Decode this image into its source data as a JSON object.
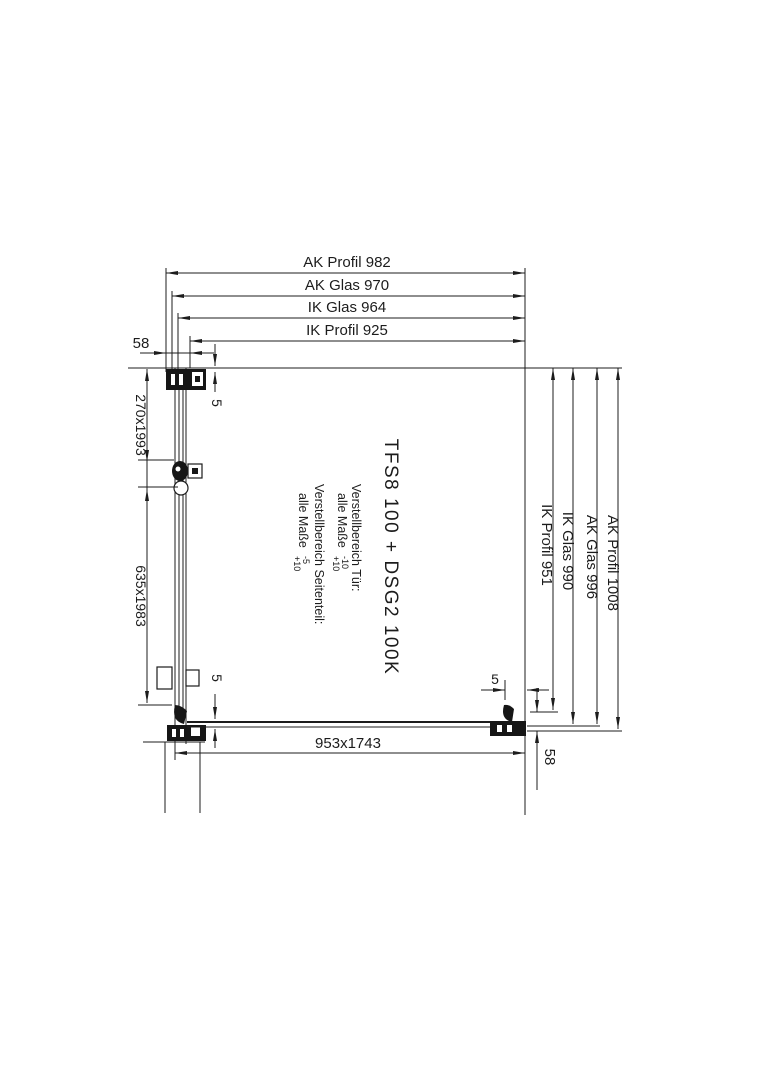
{
  "drawing": {
    "colors": {
      "line": "#1c1c1c",
      "background": "#ffffff"
    },
    "top_dims": [
      {
        "label": "AK Profil 982"
      },
      {
        "label": "AK Glas 970"
      },
      {
        "label": "IK Glas 964"
      },
      {
        "label": "IK Profil 925"
      }
    ],
    "right_dims": [
      {
        "label": "IK Profil 951"
      },
      {
        "label": "IK Glas 990"
      },
      {
        "label": "AK Glas 996"
      },
      {
        "label": "AK Profil 1008"
      }
    ],
    "panel_dims": {
      "fixed_glass": "270x1993",
      "door_glass": "635x1983",
      "side_panel_glass": "953x1743"
    },
    "offsets": {
      "wall_offset_top_left": "58",
      "wall_offset_bottom_right": "58",
      "glass_inset_top_left": "5",
      "glass_inset_bottom_left": "5",
      "glass_inset_bottom_right": "5"
    },
    "center": {
      "product": "TFS8 100 + DSG2 100K",
      "door_adjust_label": "Verstellbereich Tür:",
      "door_adjust_prefix": "alle Maße",
      "door_tol_minus": "-10",
      "door_tol_plus": "+10",
      "side_adjust_label": "Verstellbereich Seitenteil:",
      "side_adjust_prefix": "alle Maße",
      "side_tol_minus": "-5",
      "side_tol_plus": "+10"
    }
  }
}
